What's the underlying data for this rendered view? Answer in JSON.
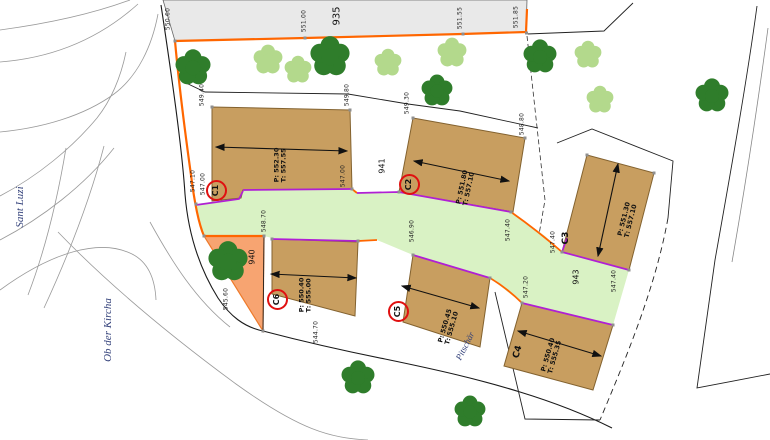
{
  "scene": {
    "width": 770,
    "height": 440
  },
  "streets": [
    {
      "text": "Sant Luzi",
      "x": 20,
      "y": 207,
      "rot": -90,
      "s": 11
    },
    {
      "text": "Ob der Kircha",
      "x": 108,
      "y": 330,
      "rot": -90,
      "s": 11
    },
    {
      "text": "Pitschär",
      "x": 465,
      "y": 346,
      "rot": -63,
      "s": 9
    }
  ],
  "parcel_numbers": [
    {
      "text": "935",
      "x": 337,
      "y": 16,
      "rot": -90,
      "s": 10
    },
    {
      "text": "940",
      "x": 253,
      "y": 257,
      "rot": -90,
      "s": 8
    },
    {
      "text": "941",
      "x": 383,
      "y": 166,
      "rot": -90,
      "s": 8
    },
    {
      "text": "943",
      "x": 577,
      "y": 277,
      "rot": -90,
      "s": 8
    }
  ],
  "spot_elevations": [
    {
      "text": "550.60",
      "x": 169,
      "y": 19,
      "rot": -90
    },
    {
      "text": "551.00",
      "x": 305,
      "y": 21,
      "rot": -90
    },
    {
      "text": "551.55",
      "x": 461,
      "y": 18,
      "rot": -90
    },
    {
      "text": "551.85",
      "x": 517,
      "y": 17,
      "rot": -90
    },
    {
      "text": "549.40",
      "x": 203,
      "y": 95,
      "rot": -90
    },
    {
      "text": "549.80",
      "x": 348,
      "y": 95,
      "rot": -90
    },
    {
      "text": "549.30",
      "x": 408,
      "y": 103,
      "rot": -90
    },
    {
      "text": "548.80",
      "x": 523,
      "y": 124,
      "rot": -90
    },
    {
      "text": "547.10",
      "x": 194,
      "y": 181,
      "rot": -90
    },
    {
      "text": "547.00",
      "x": 204,
      "y": 184,
      "rot": -90
    },
    {
      "text": "547.00",
      "x": 344,
      "y": 176,
      "rot": -90
    },
    {
      "text": "548.70",
      "x": 265,
      "y": 221,
      "rot": -90
    },
    {
      "text": "546.90",
      "x": 413,
      "y": 231,
      "rot": -90
    },
    {
      "text": "547.40",
      "x": 509,
      "y": 230,
      "rot": -90
    },
    {
      "text": "547.20",
      "x": 527,
      "y": 287,
      "rot": -90
    },
    {
      "text": "547.40",
      "x": 554,
      "y": 242,
      "rot": -90
    },
    {
      "text": "547.40",
      "x": 615,
      "y": 281,
      "rot": -90
    },
    {
      "text": "545.60",
      "x": 227,
      "y": 299,
      "rot": -90
    },
    {
      "text": "544.70",
      "x": 317,
      "y": 332,
      "rot": -90
    }
  ],
  "building_ids": [
    {
      "text": "C3",
      "x": 566,
      "y": 238,
      "rot": -90,
      "s": 9
    },
    {
      "text": "C4",
      "x": 518,
      "y": 352,
      "rot": -74,
      "s": 9
    }
  ],
  "building_levels": [
    {
      "text": "P: 552.30\nT: 557.55",
      "x": 281,
      "y": 165,
      "rot": -90
    },
    {
      "text": "P: 551.80\nT: 557.10",
      "x": 466,
      "y": 188,
      "rot": -78
    },
    {
      "text": "P: 551.30\nT: 557.10",
      "x": 628,
      "y": 220,
      "rot": -76
    },
    {
      "text": "P: 550.40\nT: 555.00",
      "x": 306,
      "y": 295,
      "rot": -90
    },
    {
      "text": "P: 550.45\nT: 555.10",
      "x": 449,
      "y": 327,
      "rot": -74
    },
    {
      "text": "P: 550.40\nT: 555.35",
      "x": 552,
      "y": 356,
      "rot": -74
    }
  ],
  "circled_building_ids": [
    {
      "text": "C1",
      "x": 216,
      "y": 190
    },
    {
      "text": "C2",
      "x": 409,
      "y": 184
    },
    {
      "text": "C5",
      "x": 398,
      "y": 311
    },
    {
      "text": "C6",
      "x": 277,
      "y": 299
    }
  ],
  "colors": {
    "boundary_orange": "#ff6600",
    "path_edge_purple": "#b01fd4",
    "path_green": "#d9f2c4",
    "building_tan": "#c89e60",
    "parcel_salmon": "#f7a471",
    "tree_dark": "#2f7d2b",
    "tree_light": "#b3d98c",
    "highlight_red": "#e01010",
    "strip_gray": "#e9e9e9"
  }
}
